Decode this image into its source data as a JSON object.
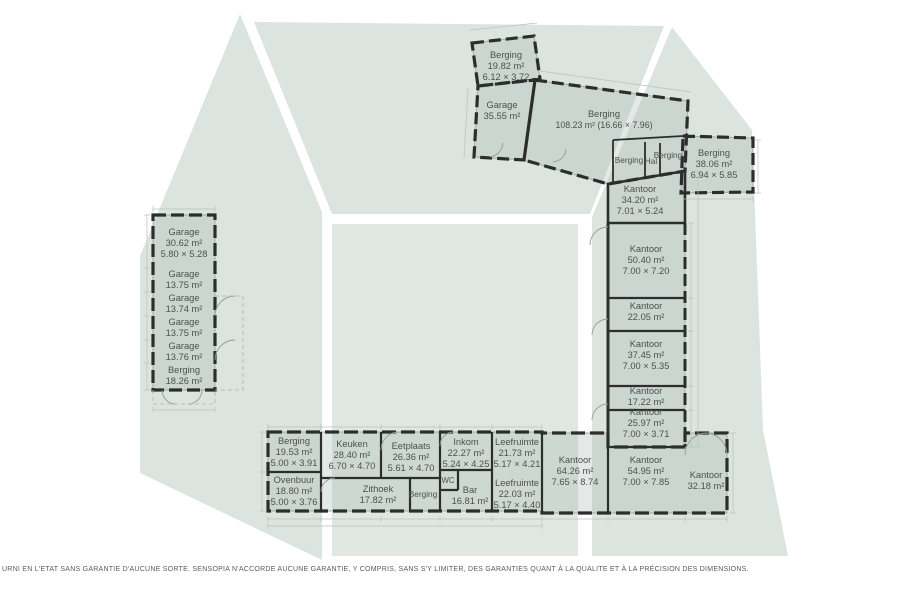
{
  "colors": {
    "watermark": "#dce4e0",
    "watermark_floor": "#e0e7e3",
    "wall": "#2c2e2d",
    "room_fill": "rgba(167,181,175,0.30)",
    "text": "#4b504e"
  },
  "rooms": {
    "top_cluster": [
      {
        "name": "Berging",
        "area": "19.82 m²",
        "dims": "6.12 × 3.72"
      },
      {
        "name": "Garage",
        "area": "35.55 m²"
      },
      {
        "name": "Berging",
        "area": "108.23 m² (16.66 × 7.96)"
      },
      {
        "name": "Berging"
      },
      {
        "name": "Hal"
      },
      {
        "name": "Berging"
      },
      {
        "name": "Berging",
        "area": "38.06 m²",
        "dims": "6.94 × 5.85"
      },
      {
        "name": "Kantoor",
        "area": "34.20 m²",
        "dims": "7.01 × 5.24"
      }
    ],
    "left_column": [
      {
        "name": "Garage",
        "area": "30.62 m²",
        "dims": "5.80 × 5.28"
      },
      {
        "name": "Garage",
        "area": "13.75 m²"
      },
      {
        "name": "Garage",
        "area": "13.74 m²"
      },
      {
        "name": "Garage",
        "area": "13.75 m²"
      },
      {
        "name": "Garage",
        "area": "13.76 m²"
      },
      {
        "name": "Berging",
        "area": "18.26 m²"
      }
    ],
    "middle_column": [
      {
        "name": "Kantoor",
        "area": "50.40 m²",
        "dims": "7.00 × 7.20"
      },
      {
        "name": "Kantoor",
        "area": "22.05 m²"
      },
      {
        "name": "Kantoor",
        "area": "37.45 m²",
        "dims": "7.00 × 5.35"
      },
      {
        "name": "Kantoor",
        "area": "17.22 m²"
      },
      {
        "name": "Kantoor",
        "area": "25.97 m²",
        "dims": "7.00 × 3.71"
      }
    ],
    "bottom_block": [
      {
        "name": "Berging",
        "area": "19.53 m²",
        "dims": "5.00 × 3.91"
      },
      {
        "name": "Ovenbuur",
        "area": "18.80 m²",
        "dims": "5.00 × 3.76"
      },
      {
        "name": "Keuken",
        "area": "28.40 m²",
        "dims": "6.70 × 4.70"
      },
      {
        "name": "Eetplaats",
        "area": "26.36 m²",
        "dims": "5.61 × 4.70"
      },
      {
        "name": "Zithoek",
        "area": "17.82 m²"
      },
      {
        "name": "Berging"
      },
      {
        "name": "WC"
      },
      {
        "name": "Bar",
        "area": "16.81 m²"
      },
      {
        "name": "Inkom",
        "area": "22.27 m²",
        "dims": "5.24 × 4.25"
      },
      {
        "name": "Leefruimte",
        "area": "21.73 m²",
        "dims": "5.17 × 4.21"
      },
      {
        "name": "Leefruimte",
        "area": "22.03 m²",
        "dims": "5.17 × 4.40"
      },
      {
        "name": "Kantoor",
        "area": "64.26 m²",
        "dims": "7.65 × 8.74"
      },
      {
        "name": "Kantoor",
        "area": "54.95 m²",
        "dims": "7.00 × 7.85"
      },
      {
        "name": "Kantoor",
        "area": "32.18 m²"
      }
    ]
  },
  "footer": {
    "disclaimer": "URNI EN L'ETAT SANS GARANTIE D'AUCUNE SORTE. SENSOPIA N'ACCORDE AUCUNE GARANTIE, Y COMPRIS, SANS S'Y LIMITER, DES GARANTIES QUANT À LA QUALITE ET À LA PRÉCISION DES DIMENSIONS."
  }
}
